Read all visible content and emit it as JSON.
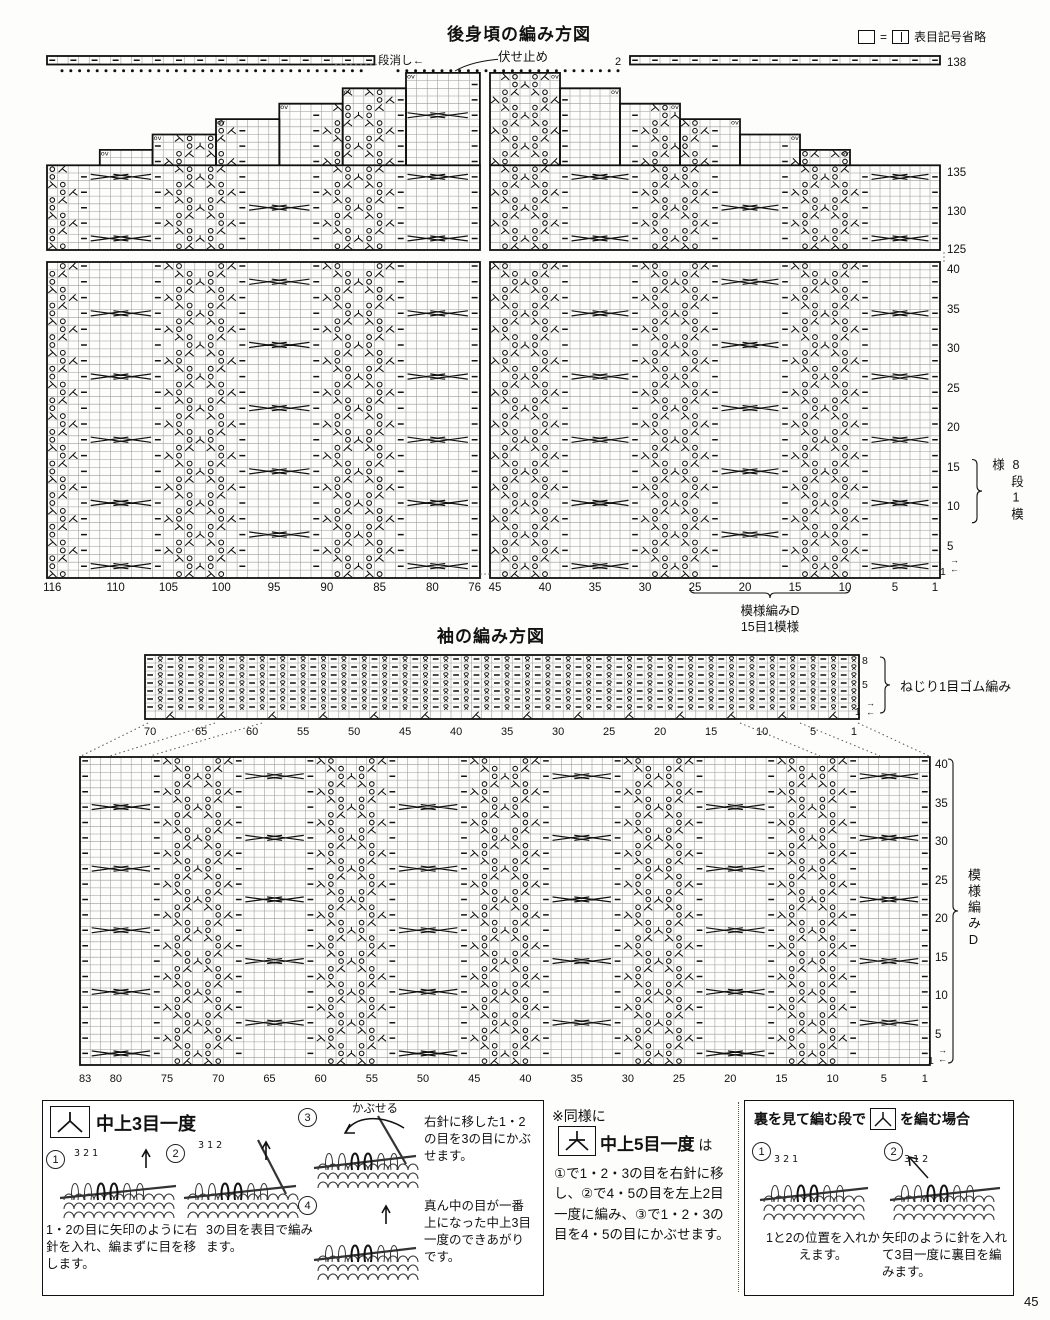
{
  "page_number": "45",
  "legend": {
    "eq": "=",
    "text": "表目記号省略"
  },
  "arrows": {
    "r": "→",
    "l": "←"
  },
  "back": {
    "title": "後身頃の編み方図",
    "dan_keshi": "段消し←",
    "fuse_dome": "伏せ止め",
    "bind_count": "2",
    "turn_mark": "ov",
    "top_row_labels": [
      "138",
      "135",
      "130",
      "125"
    ],
    "row_labels": [
      "40",
      "35",
      "30",
      "25",
      "20",
      "15",
      "10",
      "5"
    ],
    "row_one": "1",
    "repeat_bracket": "8段1模様",
    "left_col_labels": [
      "116",
      "110",
      "105",
      "100",
      "95",
      "90",
      "85",
      "80",
      "76"
    ],
    "right_col_labels": [
      "45",
      "40",
      "35",
      "30",
      "25",
      "20",
      "15",
      "10",
      "5",
      "1"
    ],
    "motif_name": "模様編みD",
    "motif_repeat": "15目1模様"
  },
  "sleeve": {
    "title": "袖の編み方図",
    "rib_row_labels": [
      "8",
      "5"
    ],
    "rib_row_one": "1",
    "rib_label": "ねじり1目ゴム編み",
    "rib_col_labels": [
      "70",
      "65",
      "60",
      "55",
      "50",
      "45",
      "40",
      "35",
      "30",
      "25",
      "20",
      "15",
      "10",
      "5",
      "1"
    ],
    "col_labels": [
      "83",
      "80",
      "75",
      "70",
      "65",
      "60",
      "55",
      "50",
      "45",
      "40",
      "35",
      "30",
      "25",
      "20",
      "15",
      "10",
      "5",
      "1"
    ],
    "row_labels": [
      "40",
      "35",
      "30",
      "25",
      "20",
      "15",
      "10",
      "5"
    ],
    "row_one": "1",
    "motif_name": "模様編みD"
  },
  "motif_d": {
    "width": 15,
    "height": 8,
    "rows": [
      "p..oAo..p......",
      "..o/.\\o........",
      "p\\o...o/p......",
      "..\\o.o/........",
      "p..oAo..p......",
      "..o/.\\o........",
      "p\\o...o/p......",
      "..\\o.o/........"
    ],
    "cable": {
      "start": 9,
      "end": 14,
      "cross_rows": [
        0,
        4
      ]
    }
  },
  "instructions": {
    "left_box": {
      "symbol_label": "中上3目一度",
      "steps": [
        "1",
        "2",
        "3",
        "4"
      ],
      "digits1": "3 2 1",
      "digits2": "3 1 2",
      "kabuseru": "かぶせる",
      "caption1": "1・2の目に矢印のように右針を入れ、編まずに目を移します。",
      "caption2": "3の目を表目で編みます。",
      "caption3": "右針に移した1・2の目を3の目にかぶせます。",
      "caption4": "真ん中の目が一番上になった中上3目一度のできあがりです。"
    },
    "note": {
      "prefix": "※同様に",
      "symbol_label": "中上5目一度",
      "wa": " は",
      "body": "①で1・2・3の目を右針に移し、②で4・5の目を左上2目一度に編み、③で1・2・3の目を4・5の目にかぶせます。"
    },
    "right_box": {
      "title_pre": "裏を見て編む段で",
      "title_post": "を編む場合",
      "steps": [
        "1",
        "2"
      ],
      "digits1": "3 2 1",
      "digits2": "3 1 2",
      "caption1": "1と2の位置を入れかえます。",
      "caption2": "矢印のように針を入れて3目一度に裏目を編みます。"
    }
  }
}
